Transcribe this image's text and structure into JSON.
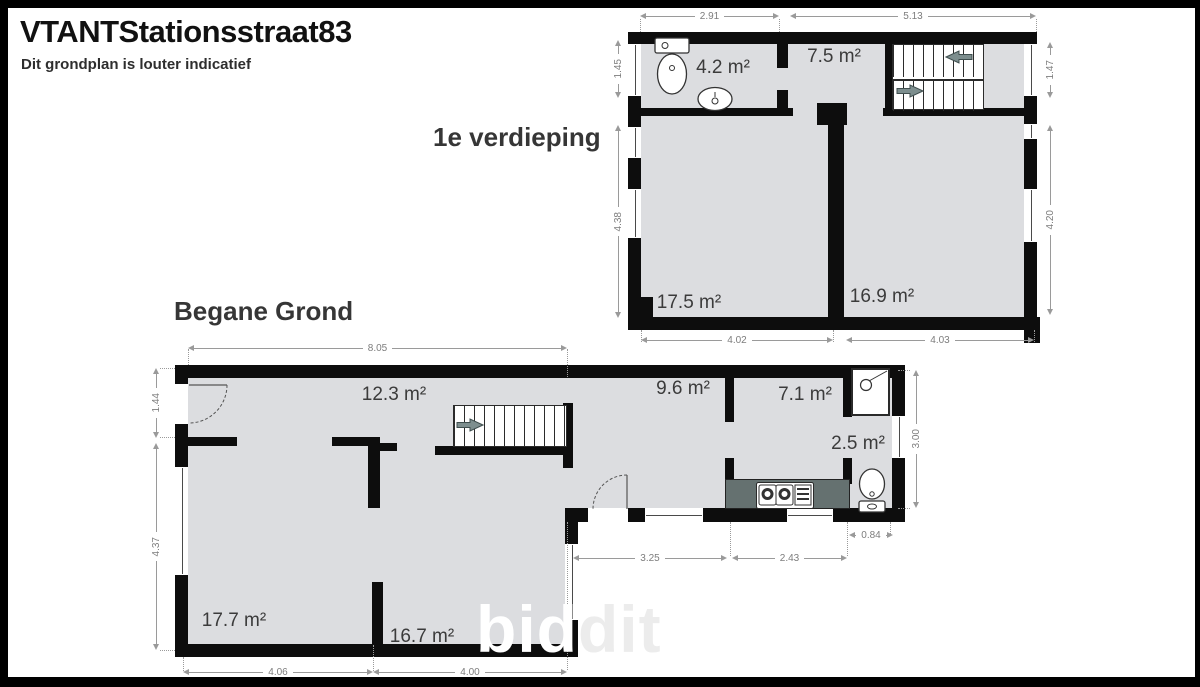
{
  "header": {
    "title": "VTANTStationsstraat83",
    "subtitle": "Dit grondplan is louter indicatief"
  },
  "watermark": {
    "part1": "bid",
    "part2": "dit"
  },
  "colors": {
    "floor_fill": "#dcdde0",
    "wall": "#0d0d0d",
    "dimension": "#9a9a9a",
    "stairs_arrow": "#7d8e8e",
    "kitchen_counter": "#657170"
  },
  "floors": {
    "first": {
      "label": "1e verdieping",
      "rooms": {
        "wc": "4.2 m²",
        "landing": "7.5 m²",
        "room_left": "17.5 m²",
        "room_right": "16.9 m²"
      },
      "dims": {
        "top_left": "2.91",
        "top_right": "5.13",
        "left_top": "1.45",
        "left_main": "4.38",
        "right_top": "1.47",
        "right_main": "4.20",
        "bottom_left": "4.02",
        "bottom_right": "4.03"
      }
    },
    "ground": {
      "label": "Begane Grond",
      "rooms": {
        "hall": "12.3 m²",
        "room_left": "17.7 m²",
        "room_right": "16.7 m²",
        "kitchen": "9.6 m²",
        "dining": "7.1 m²",
        "bathroom": "2.5 m²"
      },
      "dims": {
        "top": "8.05",
        "left_top": "1.44",
        "left_main": "4.37",
        "bottom_left": "4.06",
        "bottom_right": "4.00",
        "annex_left": "3.25",
        "annex_right": "2.43",
        "annex_depth": "0.84",
        "right": "3.00"
      }
    }
  }
}
